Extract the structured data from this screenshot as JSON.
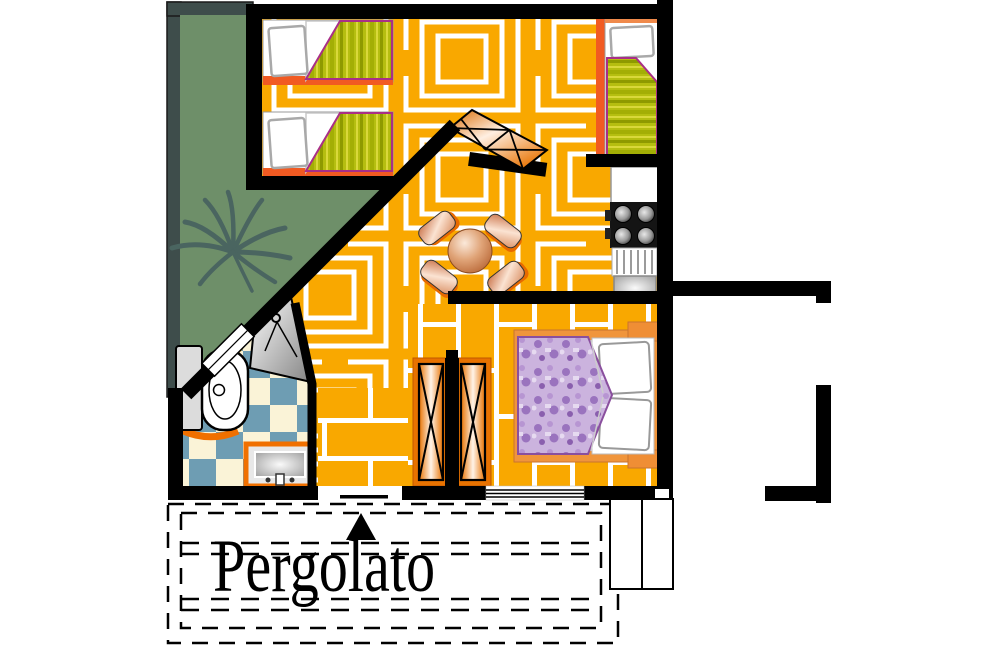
{
  "title": "Bungalow floor plan with pergola",
  "pergola": {
    "label": "Pergolato"
  },
  "colors": {
    "wall": "#000000",
    "floor": "#F9A800",
    "floor_line": "#FFFFFF",
    "garden": "#6E8F69",
    "garden_border": "#3E4D4B",
    "palm": "#4A6560",
    "checker_blue": "#6E9DB3",
    "checker_cream": "#FAF3D7",
    "blanket_base": "#B5BE10",
    "blanket_streak_dark": "#8E9A00",
    "blanket_streak_mid": "#A3AE05",
    "blanket_streak_light": "#D9D83A",
    "blanket_border": "#A92F87",
    "bedframe_orange": "#F15A22",
    "furniture_orange": "#F0953C",
    "wardrobe_orange": "#E87200",
    "vanity_border_orange": "#F07000",
    "purple_light": "#CBB3DE",
    "purple_dark": "#9A73BE",
    "purple_border": "#8A4F9E",
    "copper_dark": "#B05A28",
    "copper_light": "#FBE9DA",
    "white": "#FFFFFF"
  }
}
